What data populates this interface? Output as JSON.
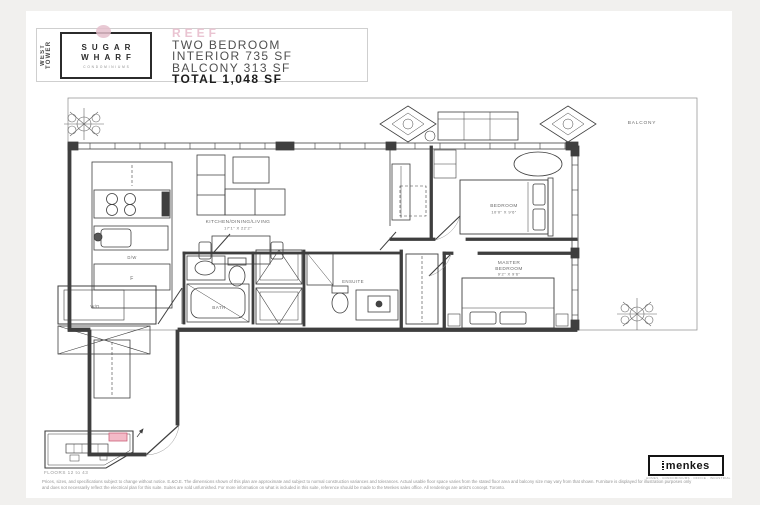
{
  "document": {
    "header": {
      "tower_label": "WEST TOWER",
      "logo": {
        "line1": "SUGAR",
        "line2": "WHARF",
        "subtitle": "CONDOMINIUMS"
      },
      "plan_name": "REEF",
      "unit_type": "TWO BEDROOM",
      "interior_area": "INTERIOR 735 SF",
      "balcony_area": "BALCONY 313 SF",
      "total_area": "TOTAL 1,048 SF"
    },
    "floorplan": {
      "labels": {
        "kitchen_dining_living": "KITCHEN/DINING/LIVING",
        "kitchen_dims": "17'1\" X 22'2\"",
        "bedroom": "BEDROOM",
        "bedroom_dims": "10'0\" X 9'6\"",
        "master_line1": "MASTER",
        "master_line2": "BEDROOM",
        "master_dims": "9'2\" X 9'6\"",
        "bath": "BATH",
        "ensuite": "ENSUITE",
        "balcony": "BALCONY",
        "dishwasher": "D/W",
        "fridge": "F",
        "washer_dryer": "W/D"
      }
    },
    "keyplan": {
      "floors_label": "FLOORS 12 to 43"
    },
    "footer": {
      "brand": "menkes",
      "brand_tagline": "HOMES · CONDOMINIUMS · OFFICE · INDUSTRIAL",
      "disclaimer": "Prices, sizes, and specifications subject to change without notice. E.&O.E. The dimensions shown of this plan are approximate and subject to normal construction variances and tolerances. Actual usable floor space varies from the stated floor area and balcony size may vary from that shown. Furniture is displayed for illustration purposes only and does not necessarily reflect the electrical plan for this suite. Suites are sold unfurnished. For more information on what is included in this suite, reference should be made to the Menkes sales office. All renderings are artist's concept. Toronto."
    },
    "colors": {
      "accent_pink": "#eac4d2",
      "keyplan_unit_fill": "#f3bac7",
      "keyplan_unit_border": "#cb6179",
      "line": "#3f3f3f"
    }
  }
}
